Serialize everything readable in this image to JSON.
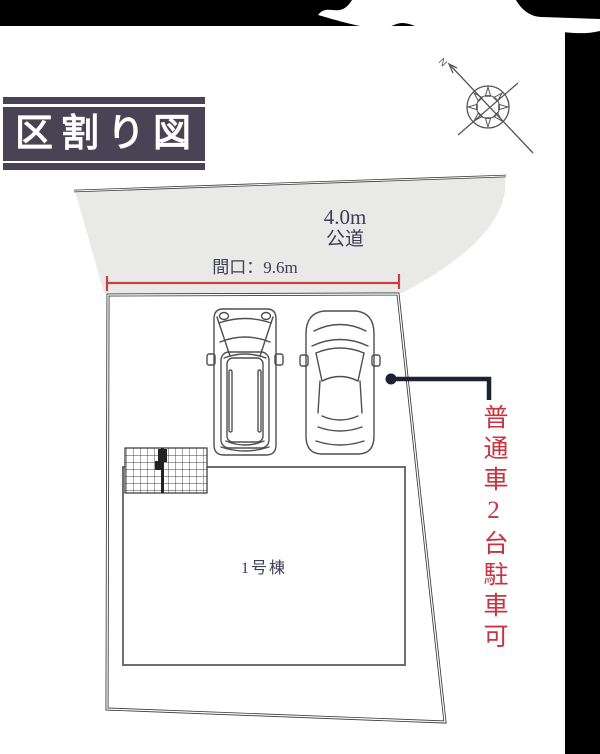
{
  "title": {
    "text": "区割り図"
  },
  "compass": {
    "north_label": "N"
  },
  "road": {
    "width_label": "4.0m",
    "type_label": "公道"
  },
  "frontage": {
    "label": "間口：9.6m"
  },
  "building": {
    "label": "1号棟"
  },
  "parking_note": {
    "label": "普通車2台駐車可"
  },
  "colors": {
    "ink": "#3d3d55",
    "red": "#c8333f",
    "title_bg": "#494455",
    "road_fill": "#e9e9e7",
    "line": "#3a3a3a",
    "leader": "#1e2033",
    "frame": "#000000",
    "paper": "#ffffff"
  }
}
